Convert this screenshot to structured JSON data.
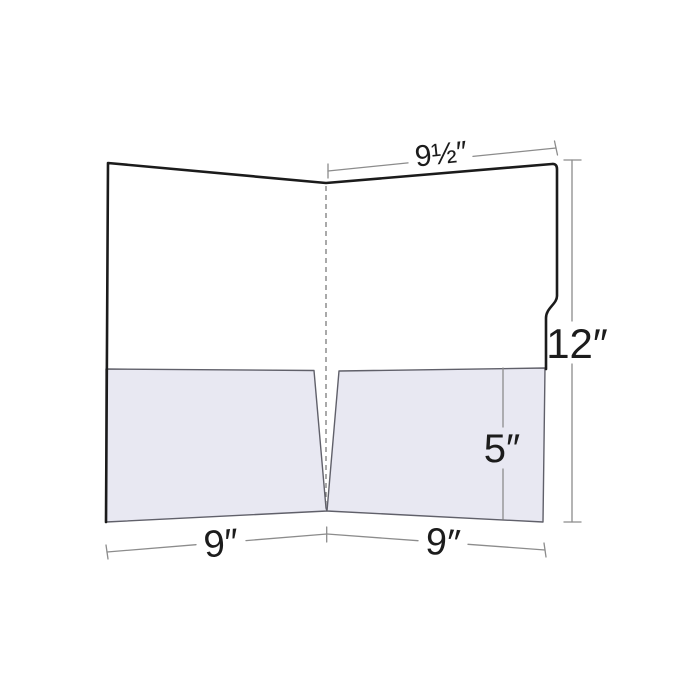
{
  "diagram": {
    "labels": {
      "top_panel_width": "9½″",
      "height": "12″",
      "pocket_height": "5″",
      "left_panel_width": "9″",
      "right_panel_width": "9″"
    },
    "colors": {
      "background": "#ffffff",
      "folder_outline": "#1b1b1b",
      "folder_fill": "#ffffff",
      "pocket_fill": "#e8e8f2",
      "pocket_outline": "#60606a",
      "spine_line": "#707070",
      "dimension_line": "#8c8c8c",
      "label_text": "#1c1c1c"
    }
  }
}
